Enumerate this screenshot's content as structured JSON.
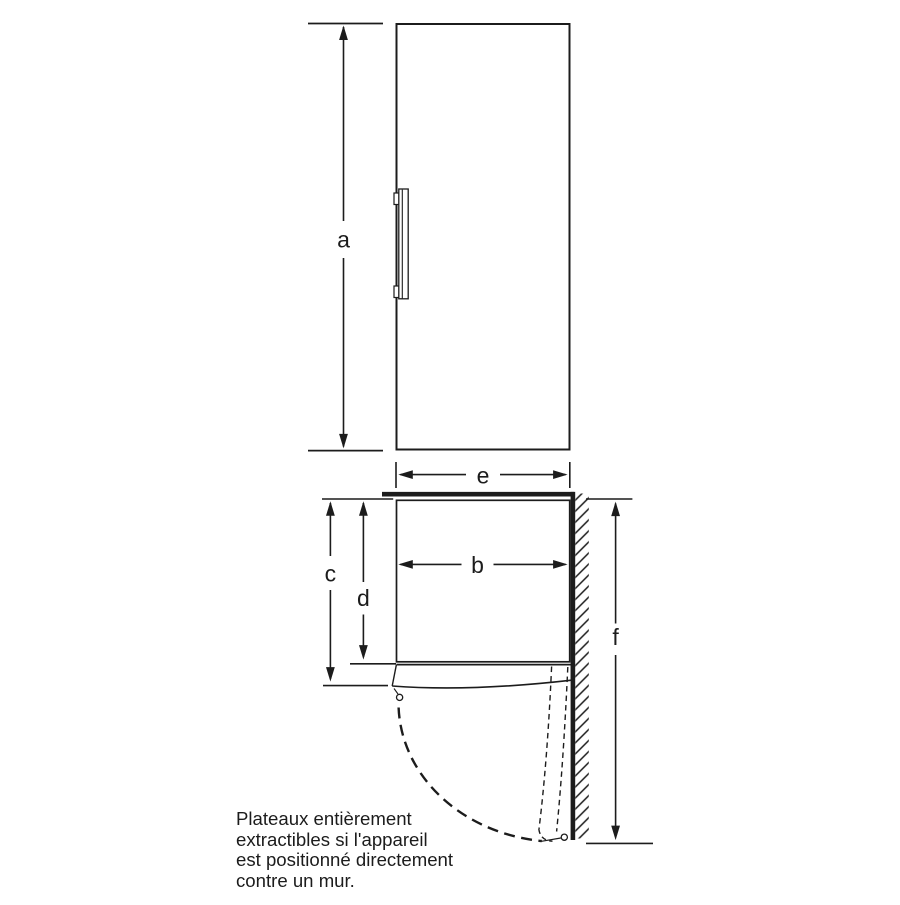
{
  "title": "Appliance dimension diagram",
  "dimensions": {
    "a": "a",
    "b": "b",
    "c": "c",
    "d": "d",
    "e": "e",
    "f": "f"
  },
  "note": {
    "text": "Plateaux entièrement\nextractibles si l'appareil\nest positionné directement\ncontre un mur."
  },
  "colors": {
    "ink": "#1c1c1c",
    "background": "#ffffff"
  }
}
